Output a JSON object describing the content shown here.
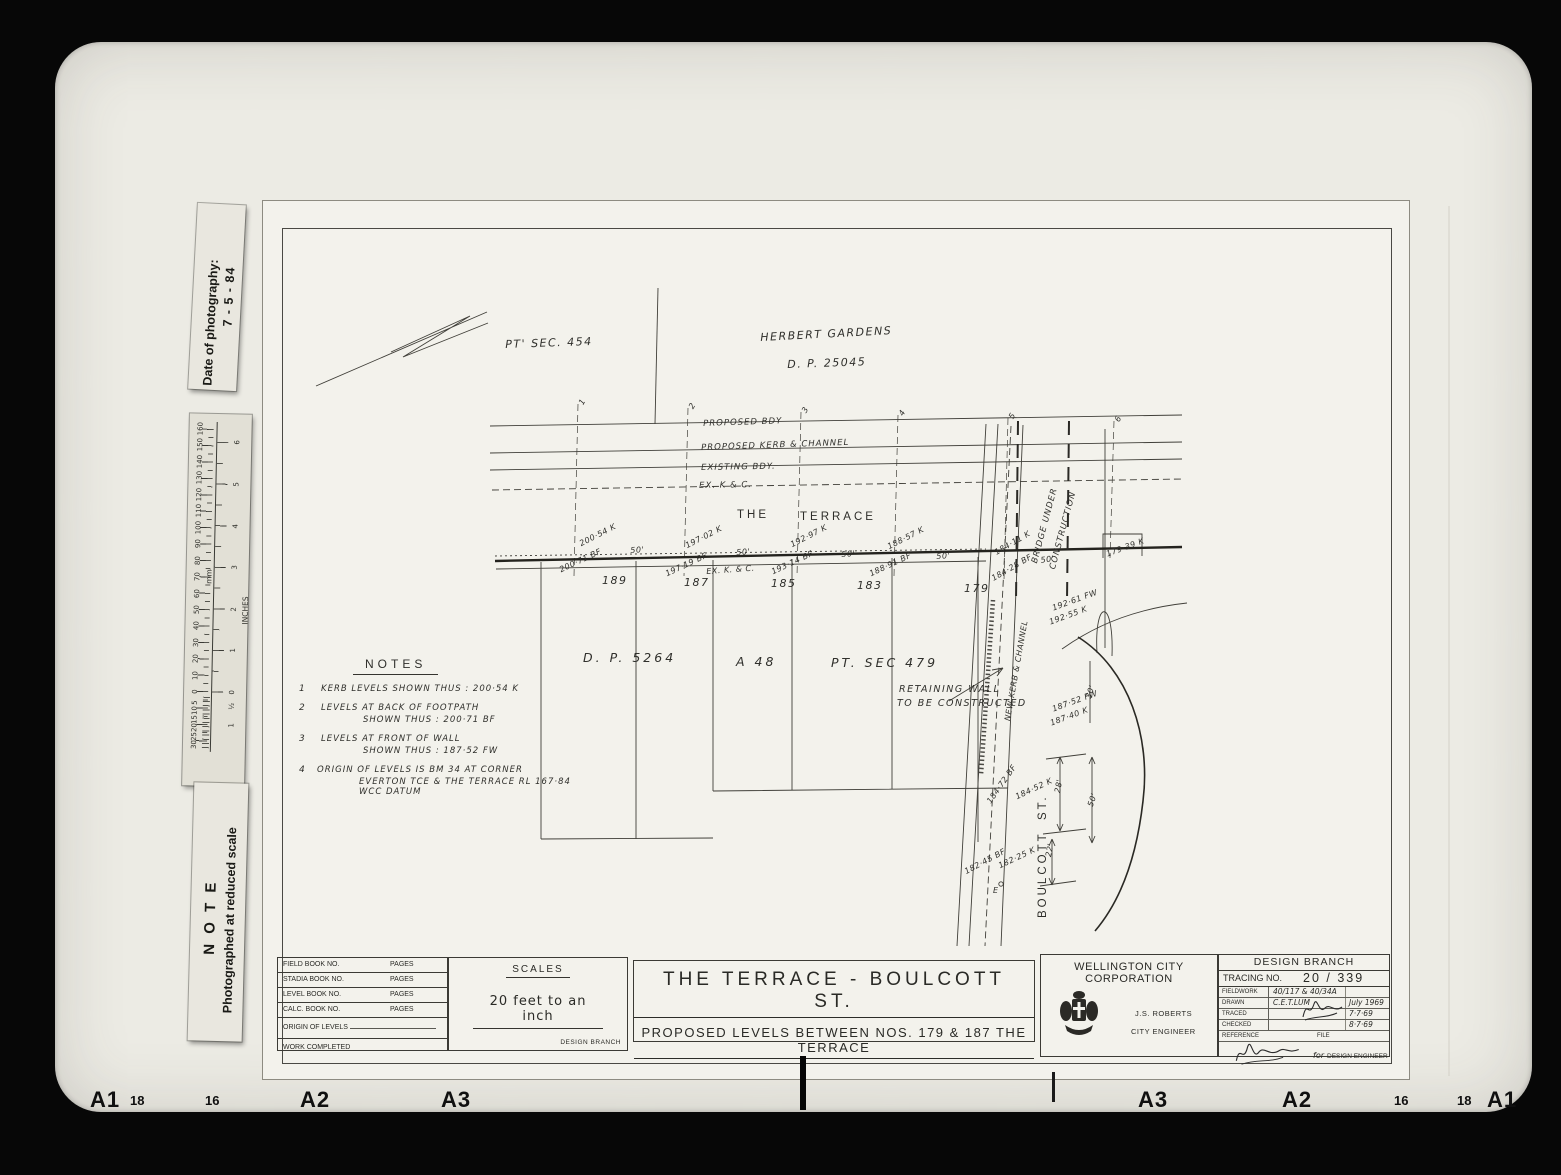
{
  "side_labels": {
    "date": {
      "line1": "Date of photography:",
      "line2": "7 - 5 - 84"
    },
    "note": {
      "line1": "N O T E",
      "line2": "Photographed at reduced scale"
    }
  },
  "ruler": {
    "unit_mm": "mm",
    "unit_inches": "INCHES",
    "labels": [
      {
        "t": "160",
        "x": 11,
        "y": 15
      },
      {
        "t": "150",
        "x": 11,
        "y": 31
      },
      {
        "t": "140",
        "x": 11,
        "y": 48
      },
      {
        "t": "130",
        "x": 11,
        "y": 64
      },
      {
        "t": "120",
        "x": 11,
        "y": 81
      },
      {
        "t": "110",
        "x": 11,
        "y": 97
      },
      {
        "t": "100",
        "x": 11,
        "y": 114
      },
      {
        "t": "90",
        "x": 11,
        "y": 130
      },
      {
        "t": "80",
        "x": 11,
        "y": 147
      },
      {
        "t": "70",
        "x": 11,
        "y": 163
      },
      {
        "t": "60",
        "x": 11,
        "y": 180
      },
      {
        "t": "50",
        "x": 11,
        "y": 196
      },
      {
        "t": "40",
        "x": 11,
        "y": 212
      },
      {
        "t": "30",
        "x": 11,
        "y": 229
      },
      {
        "t": "20",
        "x": 11,
        "y": 245
      },
      {
        "t": "10",
        "x": 11,
        "y": 262
      },
      {
        "t": "0",
        "x": 11,
        "y": 278
      },
      {
        "t": "5",
        "x": 11,
        "y": 289
      },
      {
        "t": "10",
        "x": 11,
        "y": 297
      },
      {
        "t": "15",
        "x": 11,
        "y": 306
      },
      {
        "t": "20",
        "x": 11,
        "y": 314
      },
      {
        "t": "25",
        "x": 11,
        "y": 323
      },
      {
        "t": "30",
        "x": 11,
        "y": 331
      },
      {
        "t": "6",
        "x": 48,
        "y": 28
      },
      {
        "t": "5",
        "x": 48,
        "y": 70
      },
      {
        "t": "4",
        "x": 48,
        "y": 112
      },
      {
        "t": "3",
        "x": 48,
        "y": 153
      },
      {
        "t": "2",
        "x": 48,
        "y": 195
      },
      {
        "t": "1",
        "x": 48,
        "y": 236
      },
      {
        "t": "0",
        "x": 48,
        "y": 278
      },
      {
        "t": "½",
        "x": 48,
        "y": 292
      },
      {
        "t": "1",
        "x": 48,
        "y": 311
      }
    ]
  },
  "edge_markers": [
    {
      "t": "A1",
      "x": 90,
      "big": 1
    },
    {
      "t": "18",
      "x": 130
    },
    {
      "t": "16",
      "x": 205
    },
    {
      "t": "A2",
      "x": 300,
      "big": 1
    },
    {
      "t": "A3",
      "x": 441,
      "big": 1
    },
    {
      "t": "A3",
      "x": 1138,
      "big": 1
    },
    {
      "t": "A2",
      "x": 1282,
      "big": 1
    },
    {
      "t": "16",
      "x": 1394
    },
    {
      "t": "18",
      "x": 1457
    },
    {
      "t": "A1",
      "x": 1487,
      "big": 1
    }
  ],
  "plan": {
    "annotations": [
      {
        "t": "PT' SEC. 454",
        "x": 505,
        "y": 338,
        "rot": -2,
        "cls": "hw-lg"
      },
      {
        "t": "HERBERT GARDENS",
        "x": 760,
        "y": 331,
        "rot": -3,
        "cls": "hw-lg"
      },
      {
        "t": "D. P.  25045",
        "x": 787,
        "y": 358,
        "rot": -2,
        "cls": "hw-lg"
      },
      {
        "t": "PROPOSED  BDY",
        "x": 703,
        "y": 419,
        "rot": -2,
        "cls": "hw-sm"
      },
      {
        "t": "PROPOSED  KERB  &  CHANNEL",
        "x": 701,
        "y": 443,
        "rot": -2,
        "cls": "hw-sm"
      },
      {
        "t": "EXISTING  BDY.",
        "x": 701,
        "y": 463,
        "rot": -1,
        "cls": "hw-sm"
      },
      {
        "t": "EX.  K & C.",
        "x": 699,
        "y": 481,
        "rot": -1,
        "cls": "hw-sm"
      },
      {
        "t": "THE",
        "x": 737,
        "y": 509,
        "cls": "blk"
      },
      {
        "t": "TERRACE",
        "x": 800,
        "y": 511,
        "cls": "blk"
      },
      {
        "t": "200·54 K",
        "x": 578,
        "y": 540,
        "rot": -27,
        "cls": "hw-xs"
      },
      {
        "t": "200·71 BF",
        "x": 558,
        "y": 566,
        "rot": -25,
        "cls": "hw-xs"
      },
      {
        "t": "50'",
        "x": 630,
        "y": 546,
        "rot": -4,
        "cls": "hw-xs"
      },
      {
        "t": "197·02 K",
        "x": 684,
        "y": 542,
        "rot": -27,
        "cls": "hw-xs"
      },
      {
        "t": "197·19 BF",
        "x": 664,
        "y": 570,
        "rot": -25,
        "cls": "hw-xs"
      },
      {
        "t": "EX. K. & C.",
        "x": 706,
        "y": 567,
        "rot": -4,
        "cls": "hw-xs"
      },
      {
        "t": "50'",
        "x": 736,
        "y": 548,
        "rot": -4,
        "cls": "hw-xs"
      },
      {
        "t": "192·97 K",
        "x": 789,
        "y": 541,
        "rot": -27,
        "cls": "hw-xs"
      },
      {
        "t": "193·14 BF",
        "x": 770,
        "y": 568,
        "rot": -25,
        "cls": "hw-xs"
      },
      {
        "t": "50'",
        "x": 841,
        "y": 550,
        "rot": -4,
        "cls": "hw-xs"
      },
      {
        "t": "188·57 K",
        "x": 886,
        "y": 543,
        "rot": -27,
        "cls": "hw-xs"
      },
      {
        "t": "188·91 BF",
        "x": 868,
        "y": 570,
        "rot": -25,
        "cls": "hw-xs"
      },
      {
        "t": "50'",
        "x": 936,
        "y": 552,
        "rot": -4,
        "cls": "hw-xs"
      },
      {
        "t": "184·11 K",
        "x": 993,
        "y": 549,
        "rot": -30,
        "cls": "hw-xs"
      },
      {
        "t": "184·28 BF",
        "x": 990,
        "y": 575,
        "rot": -30,
        "cls": "hw-xs"
      },
      {
        "t": "50'",
        "x": 1040,
        "y": 556,
        "rot": -8,
        "cls": "hw-xs"
      },
      {
        "t": "179·39 K",
        "x": 1105,
        "y": 550,
        "rot": -20,
        "cls": "hw-xs"
      },
      {
        "t": "189",
        "x": 602,
        "y": 574,
        "cls": "hw-lg"
      },
      {
        "t": "187",
        "x": 684,
        "y": 576,
        "cls": "hw-lg"
      },
      {
        "t": "185",
        "x": 771,
        "y": 577,
        "cls": "hw-lg"
      },
      {
        "t": "183",
        "x": 857,
        "y": 579,
        "cls": "hw-lg"
      },
      {
        "t": "179",
        "x": 964,
        "y": 582,
        "cls": "hw-lg"
      },
      {
        "t": "D. P.  5264",
        "x": 583,
        "y": 650,
        "cls": "hw-xl"
      },
      {
        "t": "A 48",
        "x": 736,
        "y": 654,
        "cls": "hw-xl"
      },
      {
        "t": "PT. SEC  479",
        "x": 831,
        "y": 655,
        "cls": "hw-xl"
      },
      {
        "t": "BRIDGE  UNDER",
        "x": 1030,
        "y": 562,
        "rot": -75,
        "cls": "hw-sm"
      },
      {
        "t": "CONSTRUCTION",
        "x": 1048,
        "y": 568,
        "rot": -75,
        "cls": "hw-sm"
      },
      {
        "t": "192·61 FW",
        "x": 1051,
        "y": 604,
        "rot": -20,
        "cls": "hw-xs"
      },
      {
        "t": "192·55 K",
        "x": 1048,
        "y": 618,
        "rot": -20,
        "cls": "hw-xs"
      },
      {
        "t": "NEW KERB & CHANNEL",
        "x": 1003,
        "y": 720,
        "rot": -80,
        "cls": "hw-xs"
      },
      {
        "t": "RETAINING  WALL",
        "x": 899,
        "y": 684,
        "cls": "hw-sm2"
      },
      {
        "t": "TO BE CONSTRUCTED",
        "x": 897,
        "y": 698,
        "cls": "hw-sm2"
      },
      {
        "t": "187·52 FW",
        "x": 1051,
        "y": 705,
        "rot": -20,
        "cls": "hw-xs"
      },
      {
        "t": "187·40 K",
        "x": 1049,
        "y": 719,
        "rot": -20,
        "cls": "hw-xs"
      },
      {
        "t": "30'",
        "x": 1084,
        "y": 697,
        "rot": -72,
        "cls": "hw-xs"
      },
      {
        "t": "184·72 BF",
        "x": 985,
        "y": 800,
        "rot": -55,
        "cls": "hw-xs"
      },
      {
        "t": "184·52 K",
        "x": 1014,
        "y": 793,
        "rot": -25,
        "cls": "hw-xs"
      },
      {
        "t": "28'",
        "x": 1053,
        "y": 792,
        "rot": -80,
        "cls": "hw-xs"
      },
      {
        "t": "50'",
        "x": 1086,
        "y": 805,
        "rot": -72,
        "cls": "hw-xs"
      },
      {
        "t": "182·45 BF",
        "x": 963,
        "y": 868,
        "rot": -28,
        "cls": "hw-xs"
      },
      {
        "t": "182·25 K",
        "x": 997,
        "y": 862,
        "rot": -25,
        "cls": "hw-xs"
      },
      {
        "t": "22'",
        "x": 1044,
        "y": 856,
        "rot": -80,
        "cls": "hw-xs"
      },
      {
        "t": "E",
        "x": 993,
        "y": 886,
        "cls": "hw-xs"
      },
      {
        "t": "ST.",
        "x": 1037,
        "y": 820,
        "rot": -90,
        "cls": "blk"
      },
      {
        "t": "BOULCOTT",
        "x": 1037,
        "y": 918,
        "rot": -90,
        "cls": "blk"
      },
      {
        "t": "1",
        "x": 577,
        "y": 402,
        "rot": -60,
        "cls": "hw-xs"
      },
      {
        "t": "2",
        "x": 687,
        "y": 406,
        "rot": -60,
        "cls": "hw-xs"
      },
      {
        "t": "3",
        "x": 800,
        "y": 410,
        "rot": -60,
        "cls": "hw-xs"
      },
      {
        "t": "4",
        "x": 897,
        "y": 413,
        "rot": -60,
        "cls": "hw-xs"
      },
      {
        "t": "5",
        "x": 1007,
        "y": 416,
        "rot": -60,
        "cls": "hw-xs"
      },
      {
        "t": "6",
        "x": 1113,
        "y": 419,
        "rot": -60,
        "cls": "hw-xs"
      }
    ]
  },
  "notes": {
    "title": "NOTES",
    "items": [
      {
        "no": "1",
        "lines": [
          "KERB LEVELS SHOWN THUS : 200·54 K"
        ]
      },
      {
        "no": "2",
        "lines": [
          "LEVELS AT BACK OF FOOTPATH",
          "SHOWN THUS : 200·71 BF"
        ]
      },
      {
        "no": "3",
        "lines": [
          "LEVELS AT FRONT OF WALL",
          "SHOWN THUS : 187·52 FW"
        ]
      },
      {
        "no": "4",
        "lines": [
          "ORIGIN OF LEVELS IS BM 34 AT CORNER",
          "EVERTON TCE & THE TERRACE RL 167·84 WCC DATUM"
        ]
      }
    ]
  },
  "title_block": {
    "field_table": {
      "rows": [
        {
          "label": "FIELD BOOK NO.",
          "pages": "PAGES"
        },
        {
          "label": "STADIA BOOK NO.",
          "pages": "PAGES"
        },
        {
          "label": "LEVEL BOOK NO.",
          "pages": "PAGES"
        },
        {
          "label": "CALC. BOOK NO.",
          "pages": "PAGES"
        }
      ],
      "origin_label": "ORIGIN OF LEVELS",
      "work_label": "WORK COMPLETED"
    },
    "scales": {
      "title": "SCALES",
      "value": "20 feet to an inch",
      "footer": "DESIGN BRANCH"
    },
    "title": {
      "line1": "THE  TERRACE - BOULCOTT  ST.",
      "line2": "PROPOSED  LEVELS  BETWEEN  NOS. 179 & 187  THE  TERRACE"
    },
    "corporation": {
      "name": "WELLINGTON CITY CORPORATION",
      "officer": "J.S. ROBERTS",
      "officer_title": "CITY ENGINEER"
    },
    "design_branch": {
      "header": "DESIGN BRANCH",
      "tracing_label": "TRACING NO.",
      "tracing_value": "20 / 339",
      "rows": [
        {
          "label": "FIELDWORK",
          "value": "40/117 & 40/34A",
          "date": ""
        },
        {
          "label": "DRAWN",
          "value": "C.E.T.LUM",
          "date": "July 1969"
        },
        {
          "label": "TRACED",
          "value": "",
          "date": "7·7·69"
        },
        {
          "label": "CHECKED",
          "value": "",
          "date": "8·7·69"
        }
      ],
      "reference_label": "REFERENCE",
      "file_label": "FILE",
      "signature_prefix": "for",
      "signature_title": "DESIGN ENGINEER"
    }
  }
}
